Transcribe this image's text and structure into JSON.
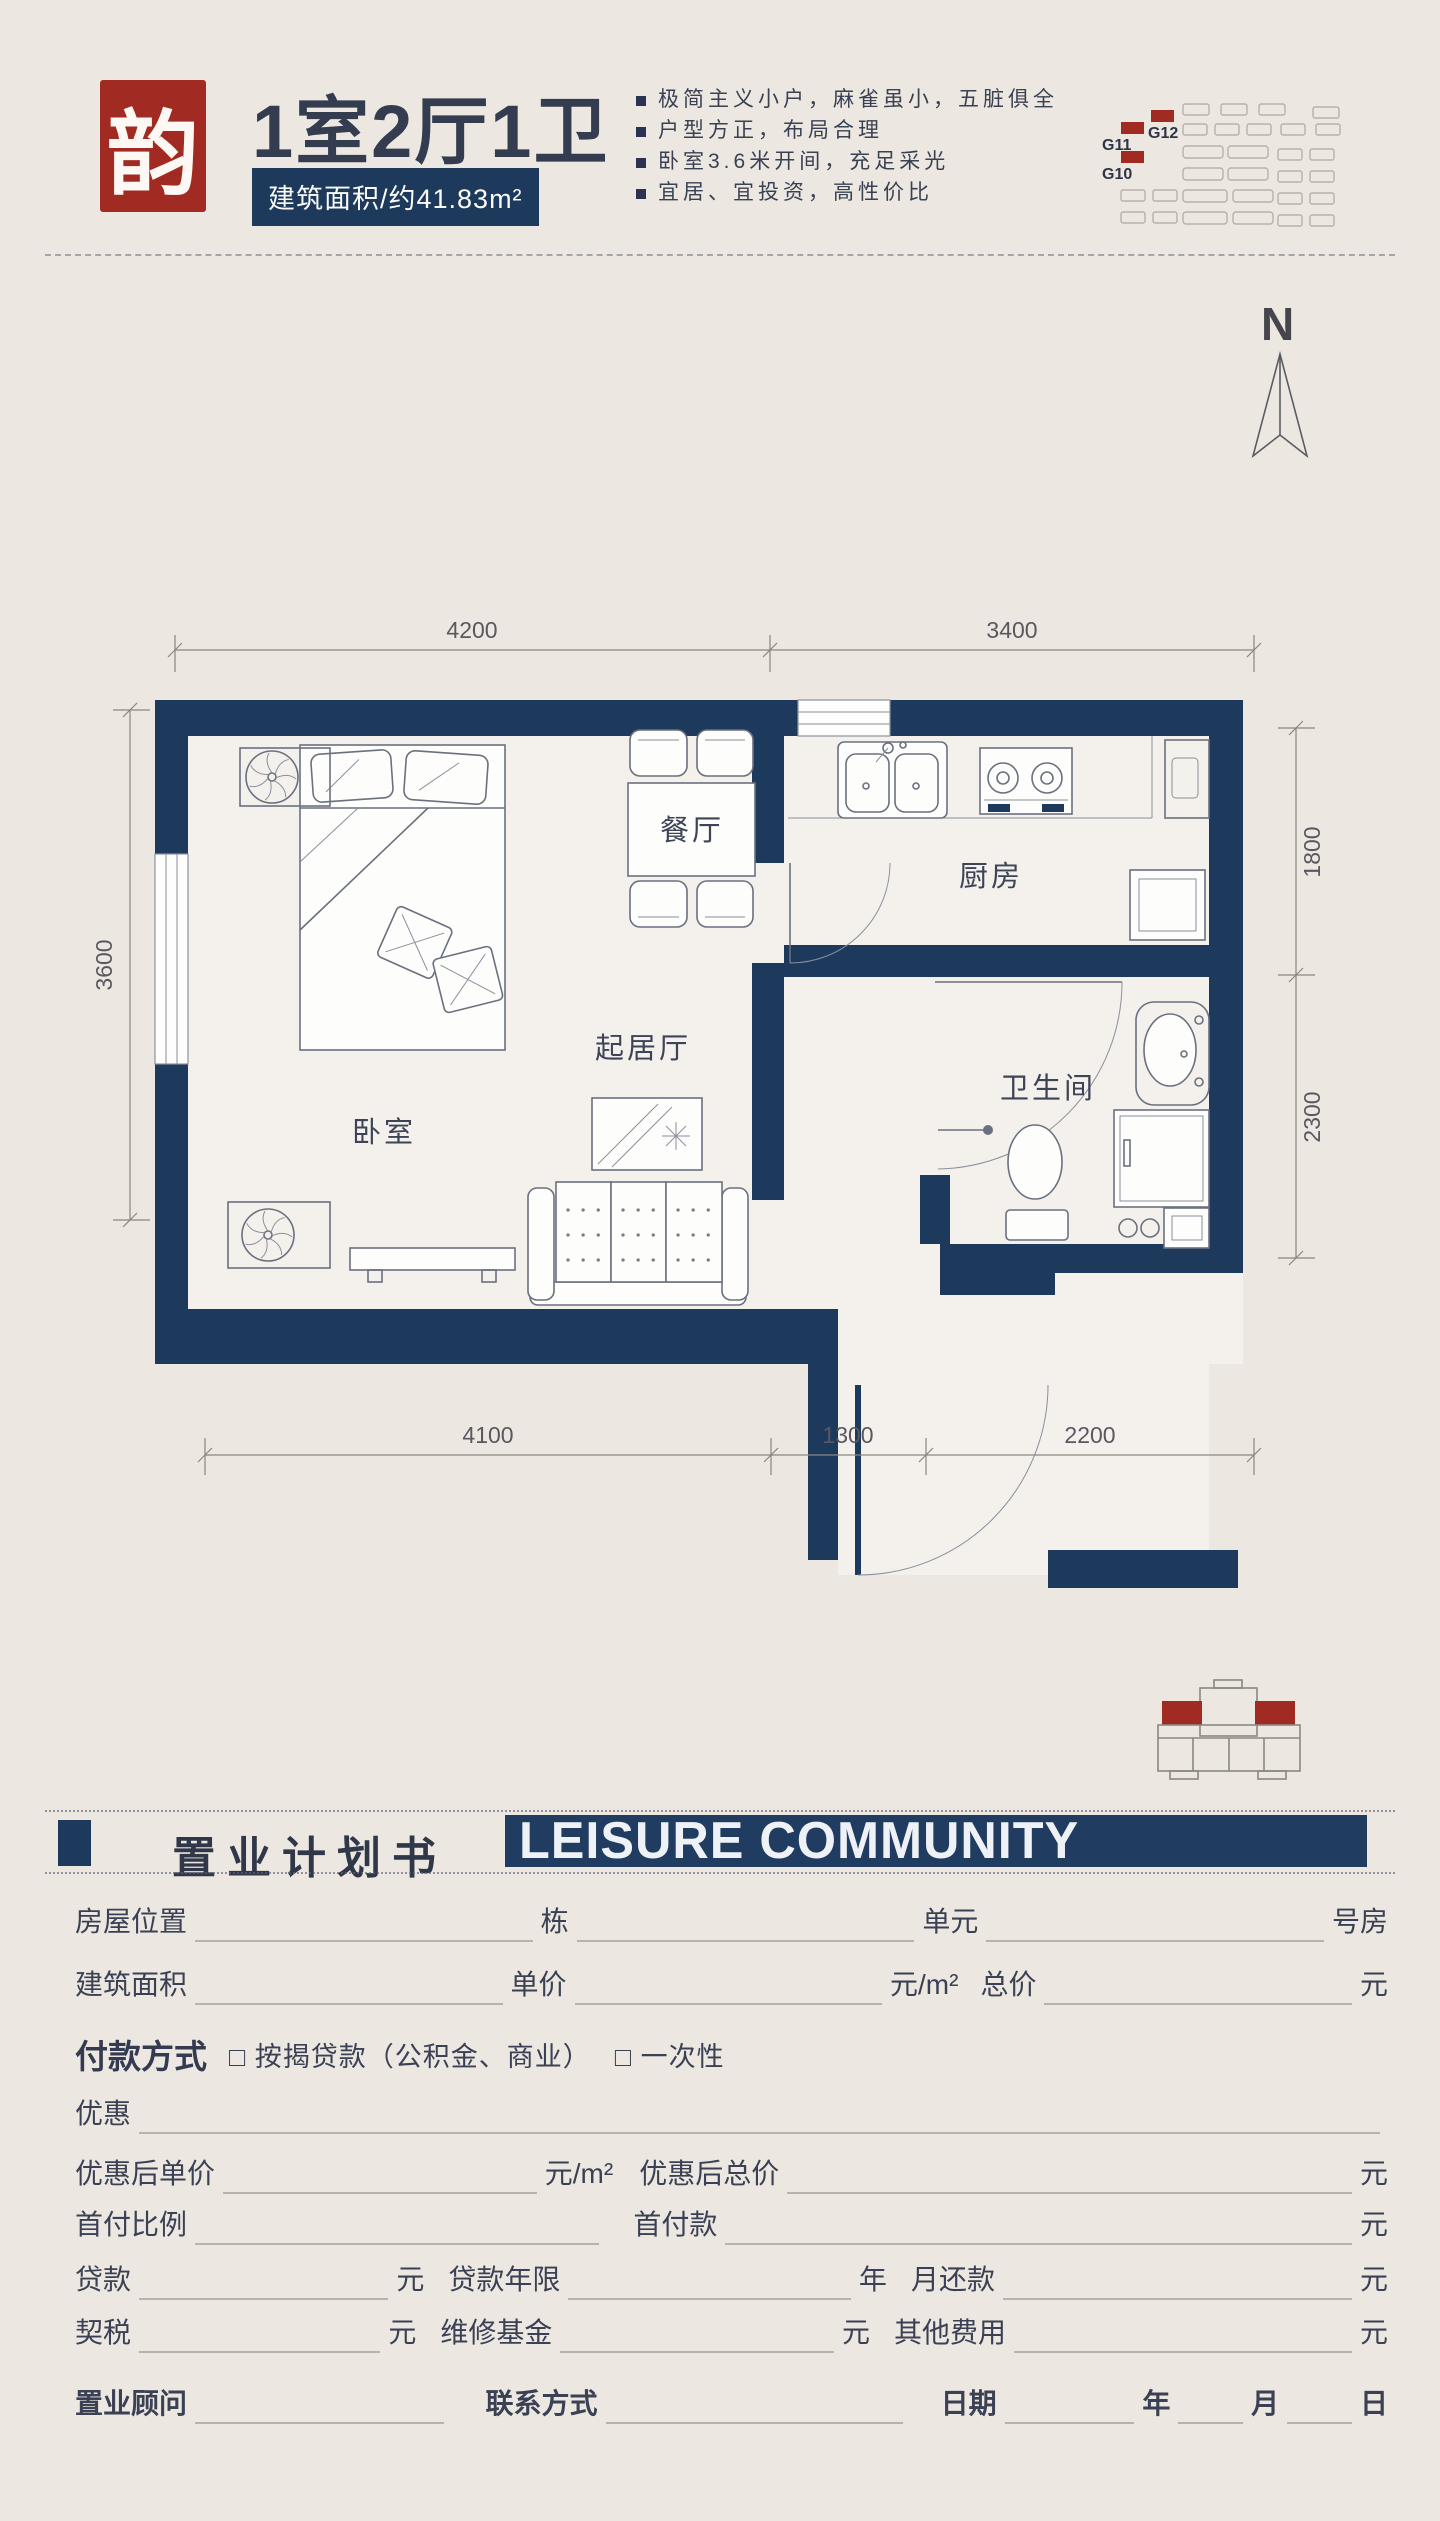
{
  "header": {
    "logo_char": "韵",
    "title": "1室2厅1卫",
    "area_badge": "建筑面积/约41.83m²",
    "bullets": [
      "极简主义小户，麻雀虽小，五脏俱全",
      "户型方正，布局合理",
      "卧室3.6米开间，充足采光",
      "宜居、宜投资，高性价比"
    ],
    "site": {
      "g12": "G12",
      "g11": "G11",
      "g10": "G10"
    }
  },
  "compass": {
    "north": "N"
  },
  "floor_plan": {
    "rooms": {
      "bedroom": "卧室",
      "dining": "餐厅",
      "living": "起居厅",
      "kitchen": "厨房",
      "bathroom": "卫生间"
    },
    "dims": {
      "top": [
        "4200",
        "3400"
      ],
      "bottom": [
        "4100",
        "1300",
        "2200"
      ],
      "left": [
        "3600"
      ],
      "right": [
        "1800",
        "2300"
      ]
    }
  },
  "book": {
    "cn": "置业计划书",
    "en": "LEISURE COMMUNITY"
  },
  "form": {
    "r1": {
      "a": "房屋位置",
      "b": "栋",
      "c": "单元",
      "d": "号房"
    },
    "r2": {
      "a": "建筑面积",
      "b": "单价",
      "c": "元/m²",
      "d": "总价",
      "e": "元"
    },
    "pay": {
      "label": "付款方式",
      "opt1": "□ 按揭贷款（公积金、商业）",
      "opt2": "□ 一次性"
    },
    "discount": {
      "a": "优惠"
    },
    "r5": {
      "a": "优惠后单价",
      "b": "元/m²",
      "c": "优惠后总价",
      "d": "元"
    },
    "r6": {
      "a": "首付比例",
      "b": "首付款",
      "c": "元"
    },
    "r7": {
      "a": "贷款",
      "b": "元",
      "c": "贷款年限",
      "d": "年",
      "e": "月还款",
      "f": "元"
    },
    "r8": {
      "a": "契税",
      "b": "元",
      "c": "维修基金",
      "d": "元",
      "e": "其他费用",
      "f": "元"
    },
    "r9": {
      "a": "置业顾问",
      "b": "联系方式",
      "c": "日期",
      "d": "年",
      "e": "月",
      "f": "日"
    },
    "colors": {
      "navy": "#1d3a5d",
      "red": "#a12b22"
    }
  }
}
